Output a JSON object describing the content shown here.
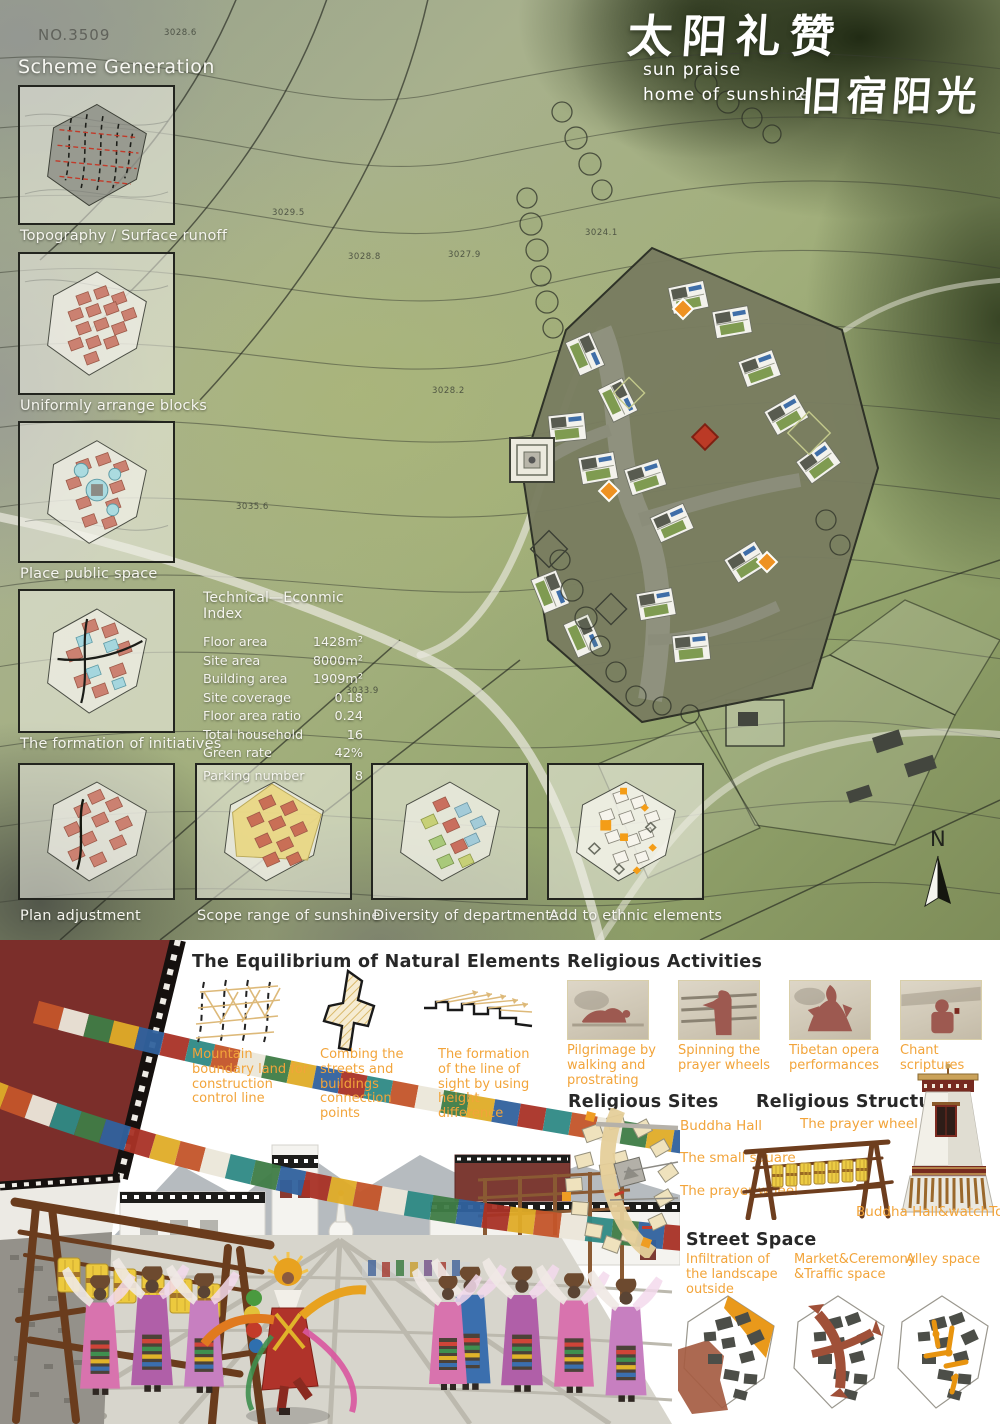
{
  "board": {
    "no": "NO.3509",
    "title_cn_main": "太阳礼赞",
    "subtitle_en_1": "sun praise",
    "subtitle_en_2": "home of sunshine",
    "subtitle_num": "2",
    "title_cn_secondary": "旧宿阳光",
    "north_label": "N"
  },
  "contours": [
    "3028.6",
    "3029.5",
    "3028.8",
    "3027.9",
    "3024.1",
    "3028.2",
    "3033.9",
    "3035.6"
  ],
  "scheme_generation": {
    "heading": "Scheme Generation",
    "steps": [
      "Topography / Surface runoff",
      "Uniformly arrange blocks",
      "Place public space",
      "The formation of initiatives",
      "Plan adjustment",
      "Scope range of sunshine",
      "Diversity of departments",
      "Add to ethnic elements"
    ]
  },
  "technical_index": {
    "heading": "Technical—Econmic Index",
    "rows": [
      {
        "label": "Floor area",
        "value": "1428m²"
      },
      {
        "label": "Site area",
        "value": "8000m²"
      },
      {
        "label": "Building area",
        "value": "1909m²"
      },
      {
        "label": "Site coverage",
        "value": "0.18"
      },
      {
        "label": "Floor area ratio",
        "value": "0.24"
      },
      {
        "label": "Total household",
        "value": "16"
      },
      {
        "label": "Green rate",
        "value": "42%"
      },
      {
        "label": "Parking number",
        "value": "8"
      }
    ]
  },
  "equilibrium": {
    "heading": "The Equilibrium of Natural Elements",
    "items": [
      "Mountain boundary land for construction control line",
      "Combing the streets and buildings connection points",
      "The formation of the line of sight by using height difference"
    ]
  },
  "religious_activities": {
    "heading": "Religious Activities",
    "items": [
      "Pilgrimage by walking and prostrating",
      "Spinning the prayer wheels",
      "Tibetan opera performances",
      "Chant scriptures"
    ]
  },
  "religious_sites": {
    "heading": "Religious Sites",
    "labels": [
      "Buddha Hall",
      "The small square",
      "The prayer wheel"
    ]
  },
  "religious_structures": {
    "heading": "Religious Structures",
    "label_top": "The prayer wheel",
    "label_bottom": "Buddha Hall&watchTower"
  },
  "street_space": {
    "heading": "Street Space",
    "items": [
      "Infiltration of the landscape outside",
      "Market&Ceremony &Traffic space",
      "Alley space"
    ]
  }
}
